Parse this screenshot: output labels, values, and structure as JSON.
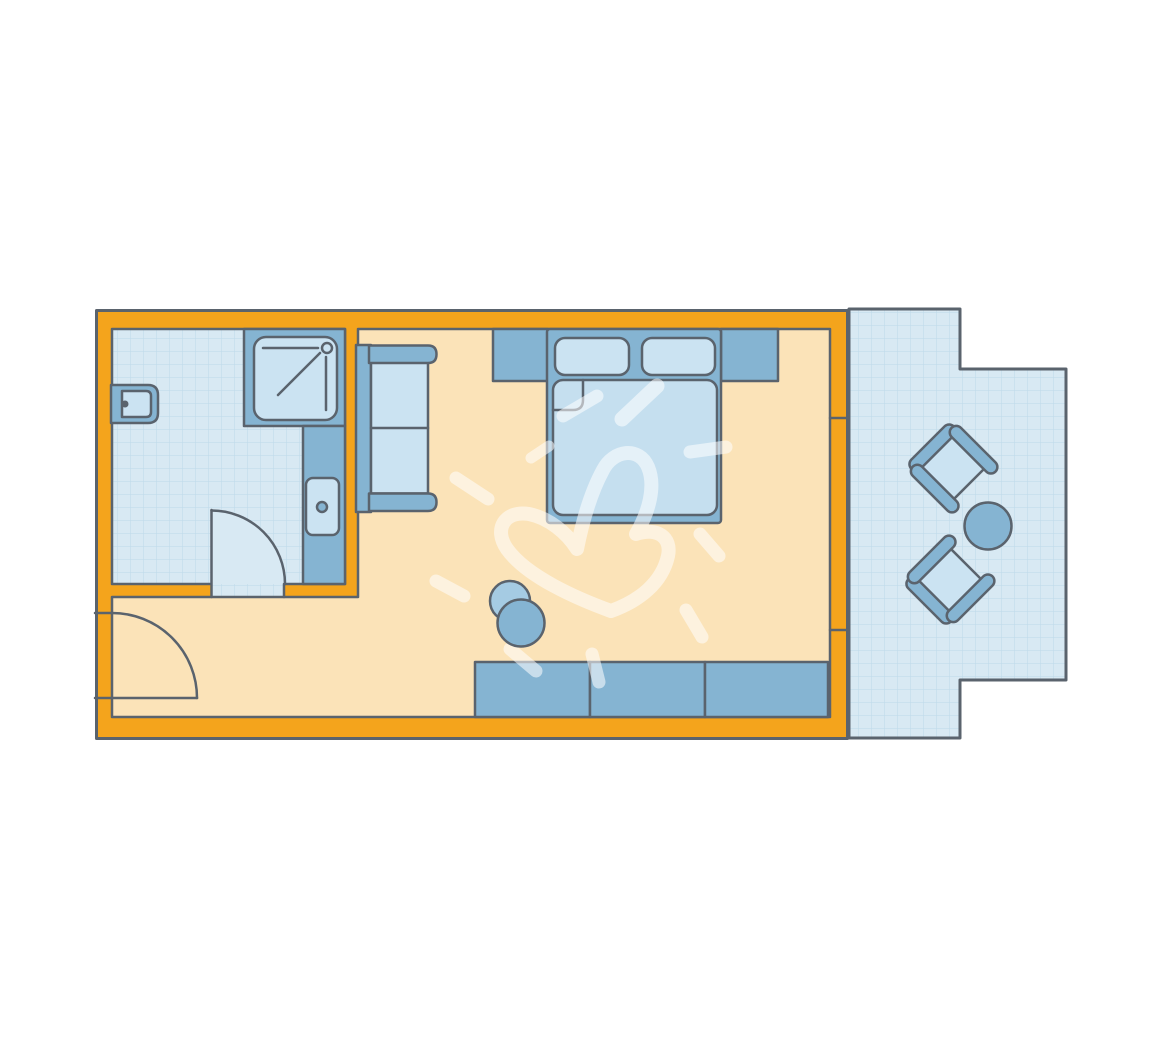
{
  "title": "hotel-room-floor-plan",
  "colors": {
    "background": "#FFFFFF",
    "outline": "#5A636D",
    "wall": "#F4A41C",
    "floor": "#FBE3B8",
    "tile": "#D8E9F3",
    "tile_grid": "#BDD9E9",
    "furniture_dark": "#85B4D2",
    "furniture_light": "#CBE3F2",
    "mattress": "#C5DFEF",
    "stool_light": "#A5CBE3",
    "watermark": "rgba(255,255,255,0.55)"
  }
}
